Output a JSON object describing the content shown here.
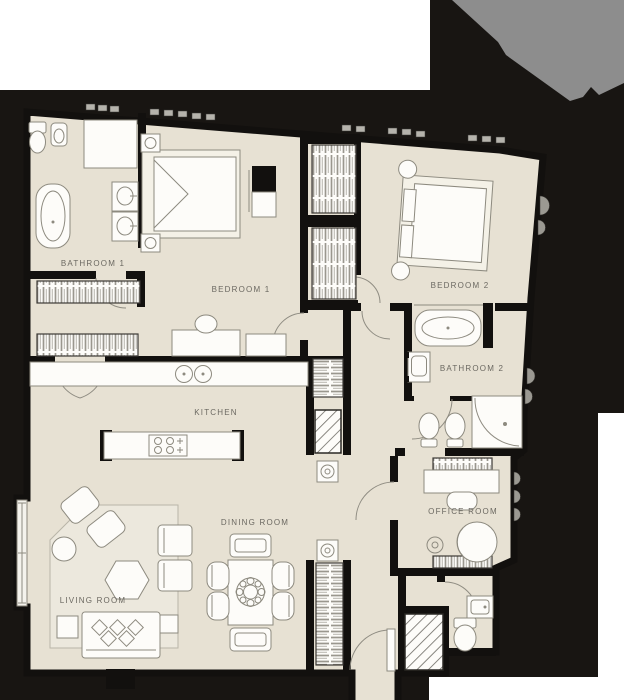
{
  "plan": {
    "rooms": [
      {
        "id": "bathroom-1",
        "label": "BATHROOM 1"
      },
      {
        "id": "bedroom-1",
        "label": "BEDROOM 1"
      },
      {
        "id": "bedroom-2",
        "label": "BEDROOM 2"
      },
      {
        "id": "bathroom-2",
        "label": "BATHROOM 2"
      },
      {
        "id": "kitchen",
        "label": "KITCHEN"
      },
      {
        "id": "dining-room",
        "label": "DINING ROOM"
      },
      {
        "id": "living-room",
        "label": "LIVING ROOM"
      },
      {
        "id": "office-room",
        "label": "OFFICE ROOM"
      }
    ]
  },
  "colors": {
    "background": "#181512",
    "mask-white": "#ffffff",
    "building-gray": "#8d8d8d",
    "wall": "#12100e",
    "floor": "#e7e1d3",
    "rug": "#ece8dd",
    "furn": "#fdfcf9",
    "furn-stroke": "#8d8a7f",
    "stripe": "#9a978e",
    "label": "#6b6861",
    "tick": "#b5b3ac"
  }
}
